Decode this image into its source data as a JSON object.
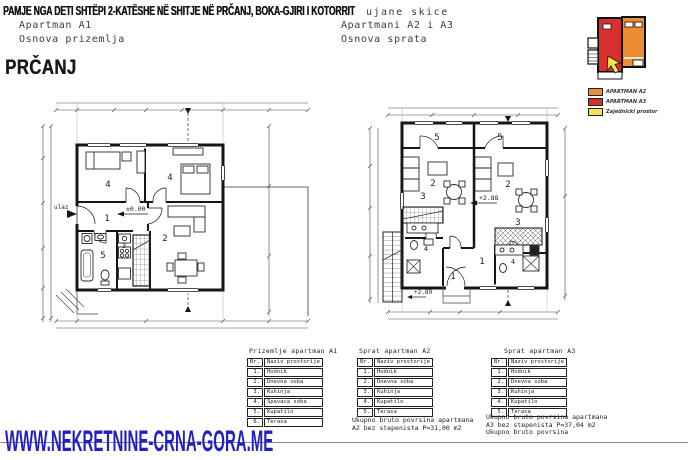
{
  "header": {
    "title": "PAMJE NGA DETI SHTËPI 2-KATËSHE NË SHITJE NË PRČANJ, BOKA-GJIRI I KOTORRIT",
    "underlay_fragment": "ujane skice",
    "location_heading": "PRČANJ"
  },
  "plans": {
    "a1": {
      "caption_line1": "Apartman A1",
      "caption_line2": "Osnova prizemlja",
      "entrance_label": "ulaz",
      "elevation": "±0.00",
      "rooms": {
        "hall": "1",
        "living": "2",
        "kitchen": "3",
        "bedroom_left": "4",
        "bedroom_right": "4",
        "bath": "5"
      }
    },
    "a23": {
      "caption_line1": "Apartmani A2 i A3",
      "caption_line2": "Osnova sprata",
      "elevation": "+2.88",
      "stair_elevation": "+2.89",
      "rooms": {
        "terrace_left": "5",
        "terrace_right": "5",
        "living_left": "2",
        "living_right": "2",
        "kitchen_left": "3",
        "kitchen_right": "3",
        "hall_left": "1",
        "hall_right": "1",
        "bath_left": "4",
        "bath_right": "4"
      }
    }
  },
  "legend": {
    "items": [
      {
        "label": "APARTMAN A2",
        "color": "#ec8c33"
      },
      {
        "label": "APARTMAN A3",
        "color": "#d92f2f"
      },
      {
        "label": "Zajednicki prostor",
        "color": "#f3e34c"
      }
    ]
  },
  "tables": {
    "a1": {
      "title": "Prizemlje apartman A1",
      "col_no": "Br.",
      "col_name": "Naziv prostorije",
      "rows": [
        [
          "1.",
          "Hodnik"
        ],
        [
          "2.",
          "Dnevna soba"
        ],
        [
          "3.",
          "Kuhinja"
        ],
        [
          "4.",
          "Spavaca soba"
        ],
        [
          "5.",
          "Kupatilo"
        ],
        [
          "6.",
          "Terasa"
        ]
      ]
    },
    "a2": {
      "title": "Sprat apartman A2",
      "col_no": "Br.",
      "col_name": "Naziv prostorije",
      "rows": [
        [
          "1.",
          "Hodnik"
        ],
        [
          "2.",
          "Dnevna soba"
        ],
        [
          "3.",
          "Kuhinja"
        ],
        [
          "4.",
          "Kupatilo"
        ],
        [
          "5.",
          "Terasa"
        ]
      ],
      "summary": [
        "Ukupno bruto povrsina apartmana",
        "A2 bez stepenista  P=31,00 m2"
      ]
    },
    "a3": {
      "title": "Sprat apartman A3",
      "col_no": "Br.",
      "col_name": "Naziv prostorije",
      "rows": [
        [
          "1.",
          "Hodnik"
        ],
        [
          "2.",
          "Dnevna soba"
        ],
        [
          "3.",
          "Kuhinja"
        ],
        [
          "4.",
          "Kupatilo"
        ],
        [
          "5.",
          "Terasa"
        ]
      ],
      "summary": [
        "Ukupno bruto povrsina apartmana",
        "A3 bez stepenista  P=37,04 m2",
        "Ukupno bruto povrsina"
      ]
    }
  },
  "footer": {
    "watermark": "WWW.NEKRETNINE-CRNA-GORA.ME"
  }
}
